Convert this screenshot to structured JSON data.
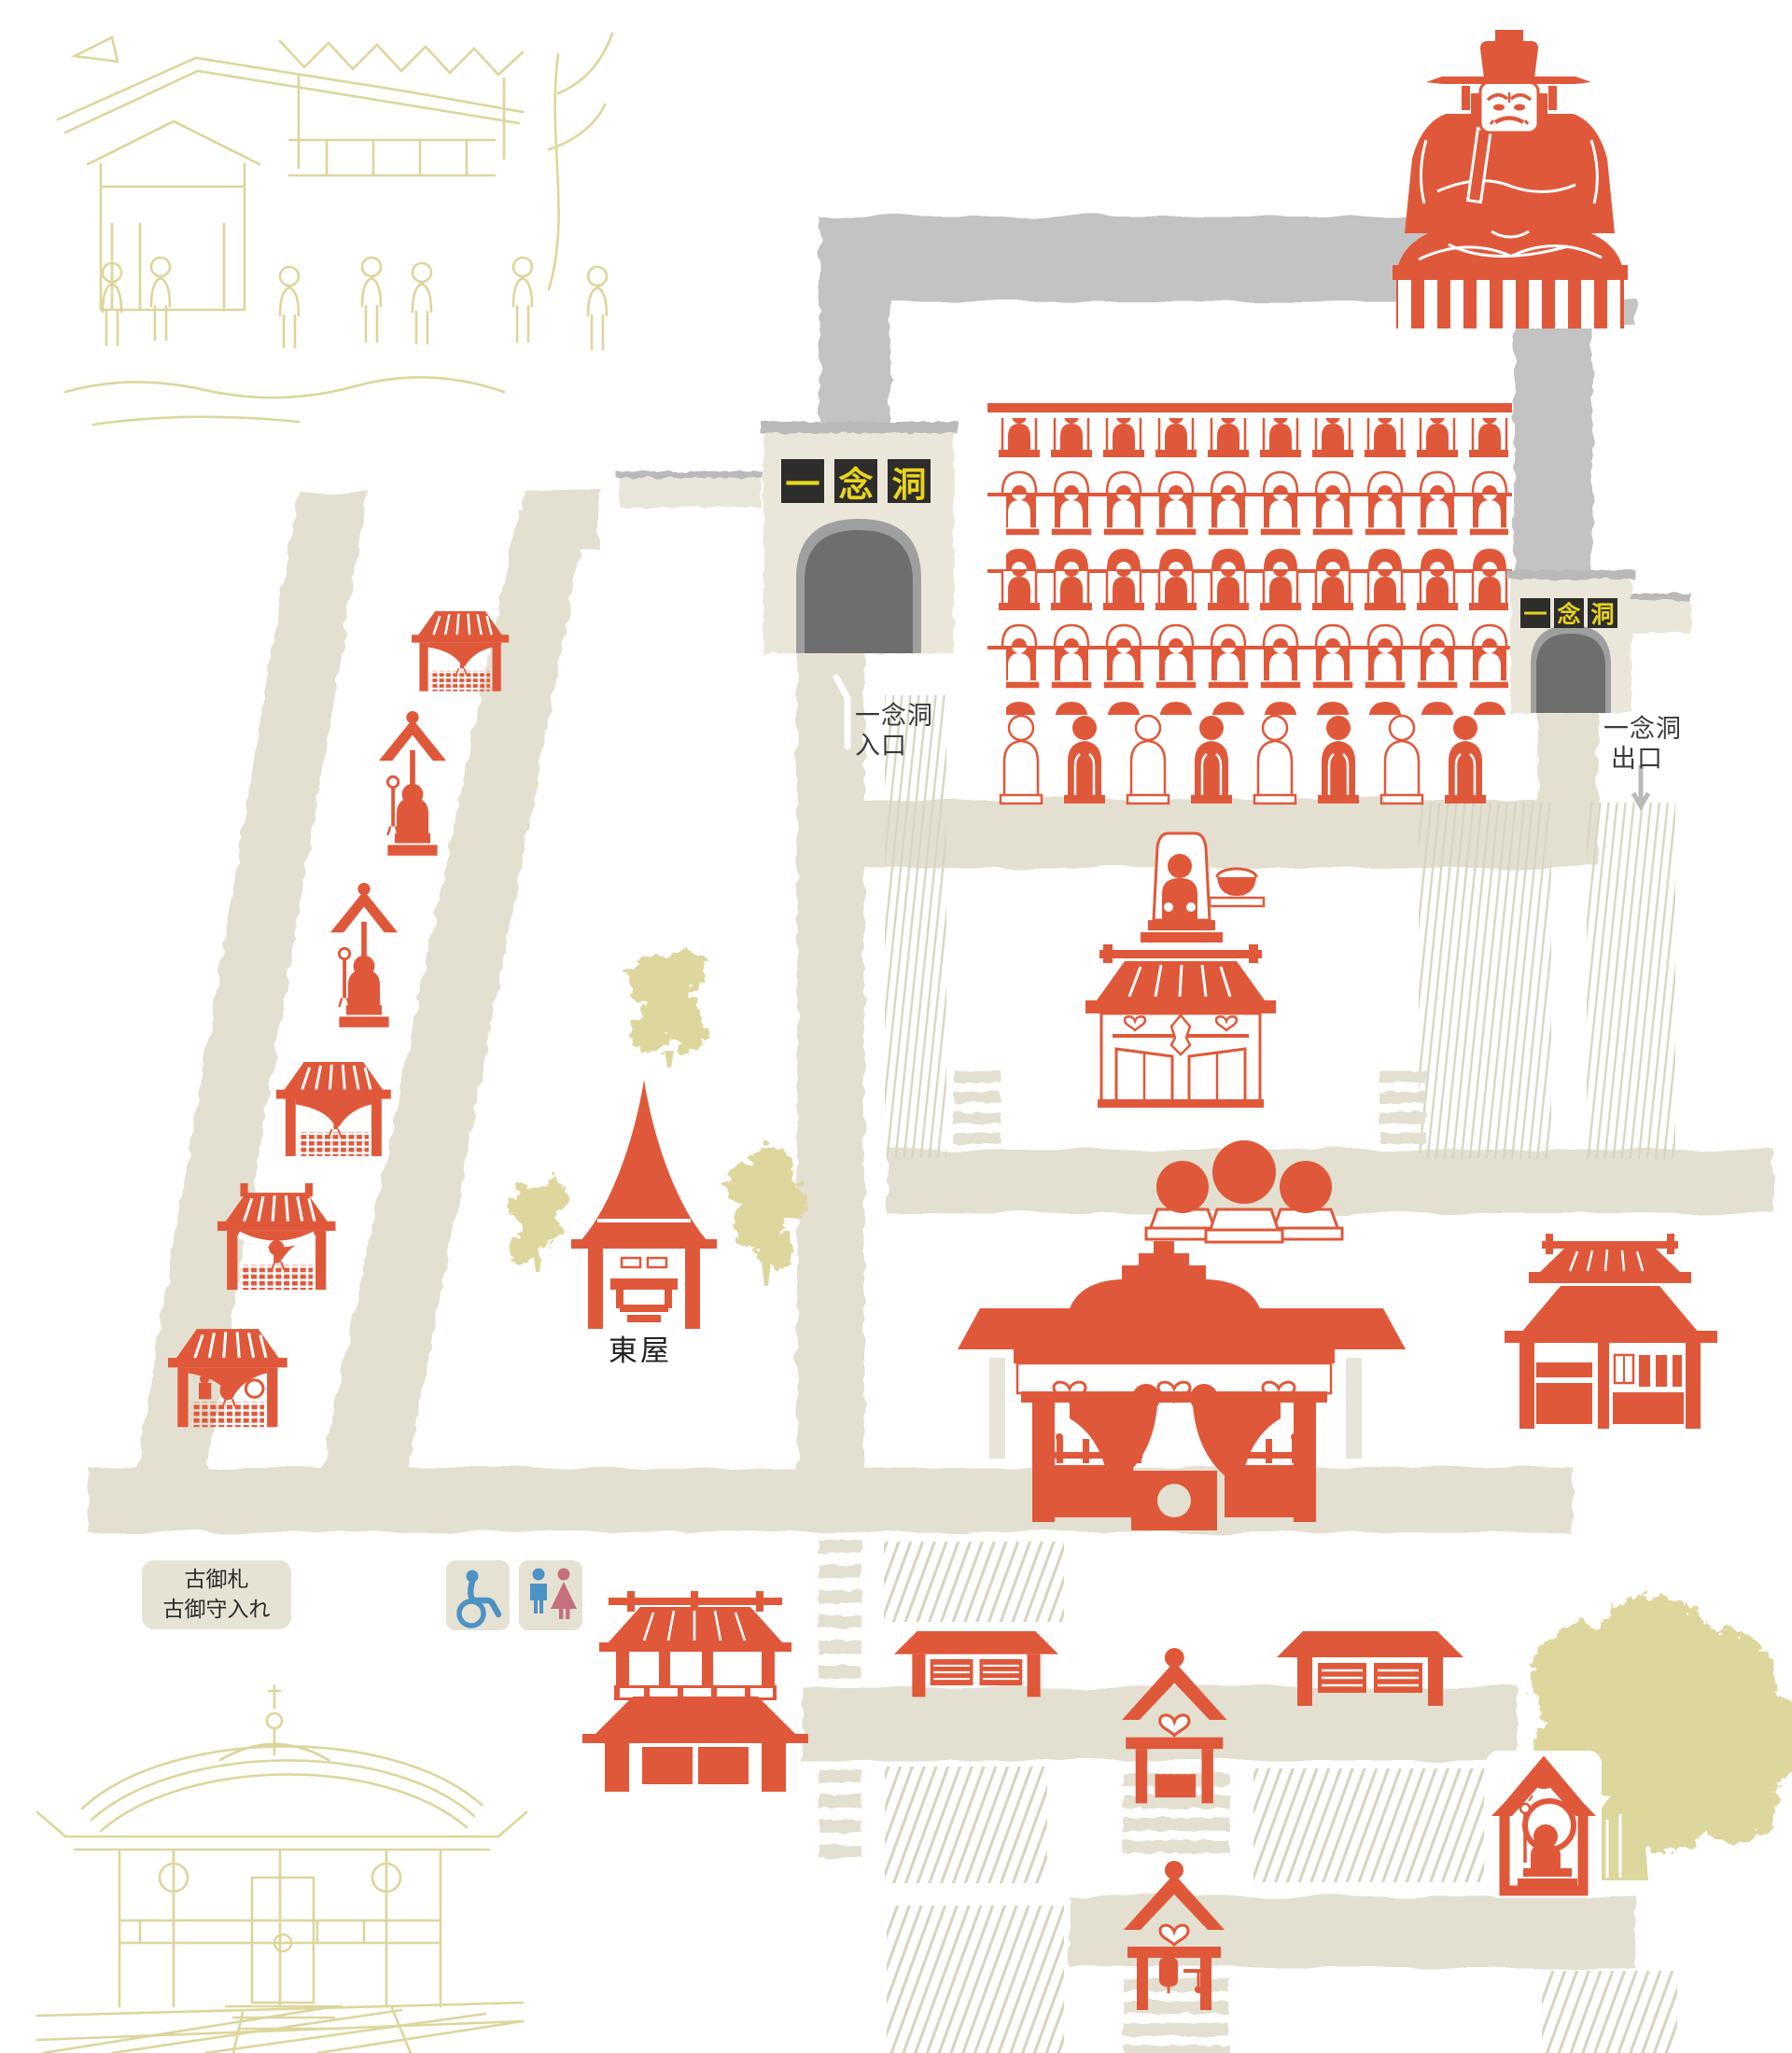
{
  "map": {
    "colors": {
      "accent_red": "#E0583A",
      "path_beige": "#E3E0D1",
      "cave_gray": "#C3C3C3",
      "tunnel_dark": "#6E6E6E",
      "tunnel_rim": "#A0A0A0",
      "structure_cream": "#EAE6D9",
      "sign_bg": "#2D2D2B",
      "sign_text": "#E8D41E",
      "sketch_khaki": "#DCD69C",
      "tree_khaki": "#DDD79E",
      "icon_bg": "#E6E2D3",
      "icon_blue": "#4E92C4",
      "icon_pink": "#C4707E"
    },
    "cave": {
      "entrance_sign": [
        "一",
        "念",
        "洞"
      ],
      "exit_sign": [
        "一",
        "念",
        "洞"
      ],
      "entrance_label": {
        "line1": "一念洞",
        "line2": "入口"
      },
      "exit_label": {
        "line1": "一念洞",
        "line2": "出口"
      }
    },
    "labels": {
      "azumaya": "東屋",
      "talisman_line1": "古御札",
      "talisman_line2": "古御守入れ"
    },
    "icons": {
      "wheelchair": "wheelchair-accessible-icon",
      "restroom": "restroom-icon"
    }
  }
}
